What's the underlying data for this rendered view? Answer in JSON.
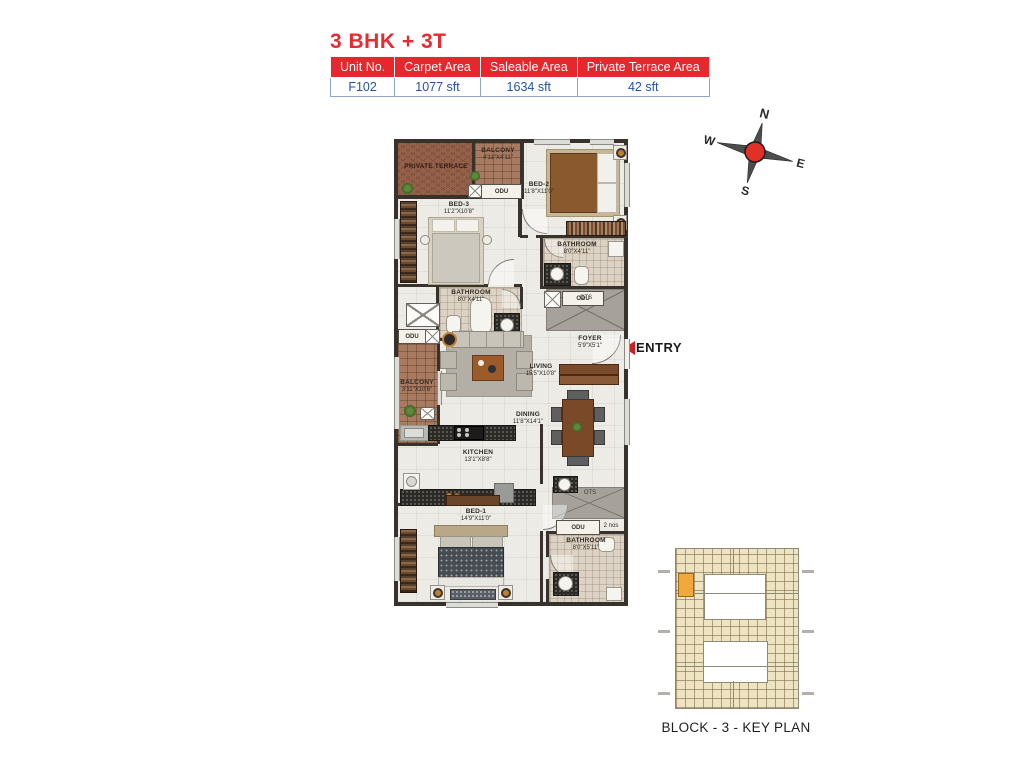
{
  "title": "3 BHK + 3T",
  "unit_table": {
    "headers": [
      "Unit No.",
      "Carpet Area",
      "Saleable Area",
      "Private Terrace Area"
    ],
    "row": [
      "F102",
      "1077 sft",
      "1634 sft",
      "42 sft"
    ]
  },
  "compass": {
    "north": "N",
    "east": "E",
    "south": "S",
    "west": "W"
  },
  "entry": {
    "label": "ENTRY"
  },
  "plan": {
    "private_terrace": {
      "name": "PRIVATE TERRACE"
    },
    "balcony_top": {
      "name": "BALCONY",
      "dims": "4'11\"X4'11\""
    },
    "bed2": {
      "name": "BED-2",
      "dims": "11'8\"X11'0\""
    },
    "bed3": {
      "name": "BED-3",
      "dims": "11'2\"X10'8\""
    },
    "bath2": {
      "name": "BATHROOM",
      "dims": "8'0\"X4'11\""
    },
    "bath3": {
      "name": "BATHROOM",
      "dims": "8'0\"X4'11\""
    },
    "foyer": {
      "name": "FOYER",
      "dims": "5'9\"X5'1\""
    },
    "living": {
      "name": "LIVING",
      "dims": "15'5\"X10'8\""
    },
    "balcony_left": {
      "name": "BALCONY",
      "dims": "3'11\"X10'8\""
    },
    "dining": {
      "name": "DINING",
      "dims": "11'8\"X14'1\""
    },
    "kitchen": {
      "name": "KITCHEN",
      "dims": "13'1\"X8'8\""
    },
    "bed1": {
      "name": "BED-1",
      "dims": "14'9\"X11'0\""
    },
    "bath1": {
      "name": "BATHROOM",
      "dims": "8'0\"X5'11\""
    },
    "odu": "ODU",
    "odu_qty": "2 nos",
    "ots": "OTS"
  },
  "key_plan": {
    "caption": "BLOCK - 3 - KEY PLAN"
  },
  "colors": {
    "accent_red": "#e8262e",
    "value_blue": "#2353a4",
    "highlight_unit": "#f2a93b"
  }
}
